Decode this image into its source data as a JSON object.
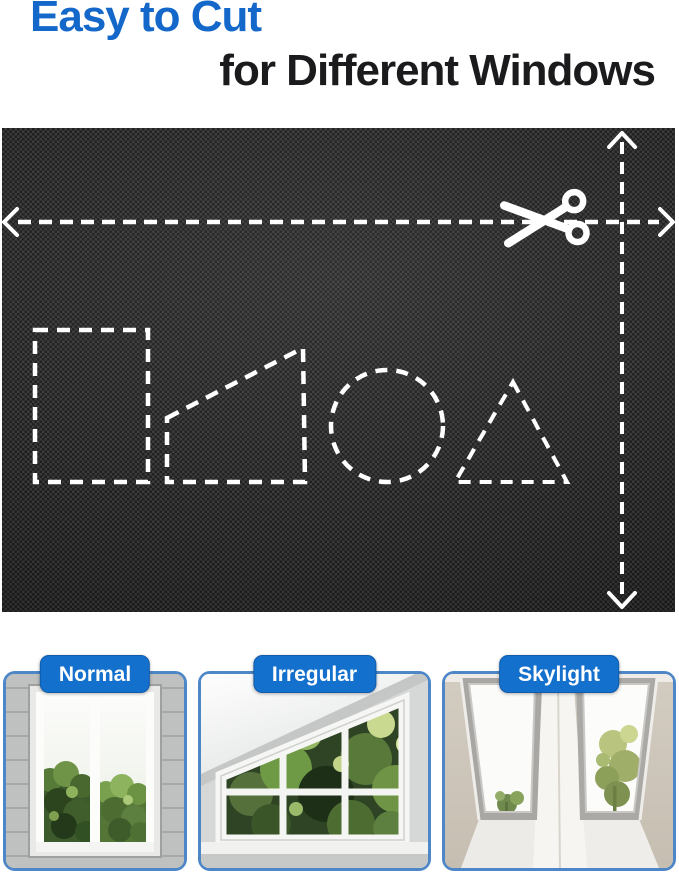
{
  "header": {
    "title_line1": "Easy to Cut",
    "title_line2": "for Different Windows"
  },
  "fabric_panel": {
    "icons": [
      "scissors-icon",
      "left-arrow-icon",
      "right-arrow-icon",
      "up-arrow-icon",
      "down-arrow-icon"
    ],
    "cut_shapes": [
      "rectangle",
      "right-trapezoid",
      "circle",
      "triangle"
    ]
  },
  "cards": [
    {
      "label": "Normal"
    },
    {
      "label": "Irregular"
    },
    {
      "label": "Skylight"
    }
  ],
  "colors": {
    "title_blue": "#1368c9",
    "title_dark": "#1b1b1d",
    "pill_blue": "#1470cd",
    "card_border_blue": "#4d87c7",
    "fabric_black": "#242424",
    "cut_line_white": "#ffffff"
  }
}
